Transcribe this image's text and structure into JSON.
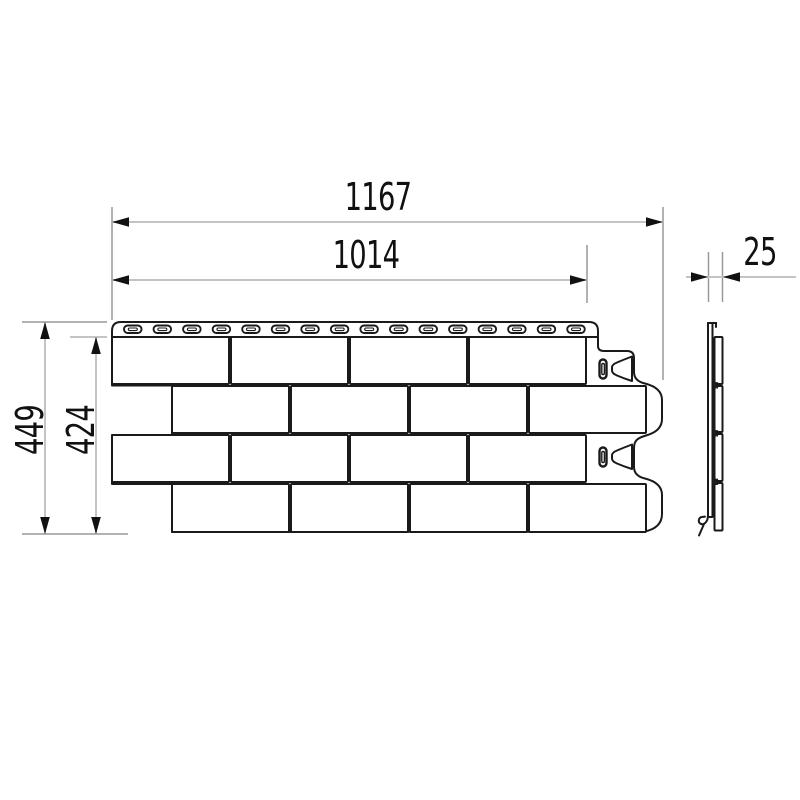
{
  "drawing": {
    "dimensions": {
      "overall_width": "1167",
      "useful_width": "1014",
      "thickness": "25",
      "overall_height": "449",
      "useful_height": "424"
    },
    "colors": {
      "background": "#ffffff",
      "outline": "#1a1a1a",
      "dimension_line": "#c4c4c4",
      "extension_line": "#999999",
      "arrow_and_text": "#111111"
    }
  }
}
